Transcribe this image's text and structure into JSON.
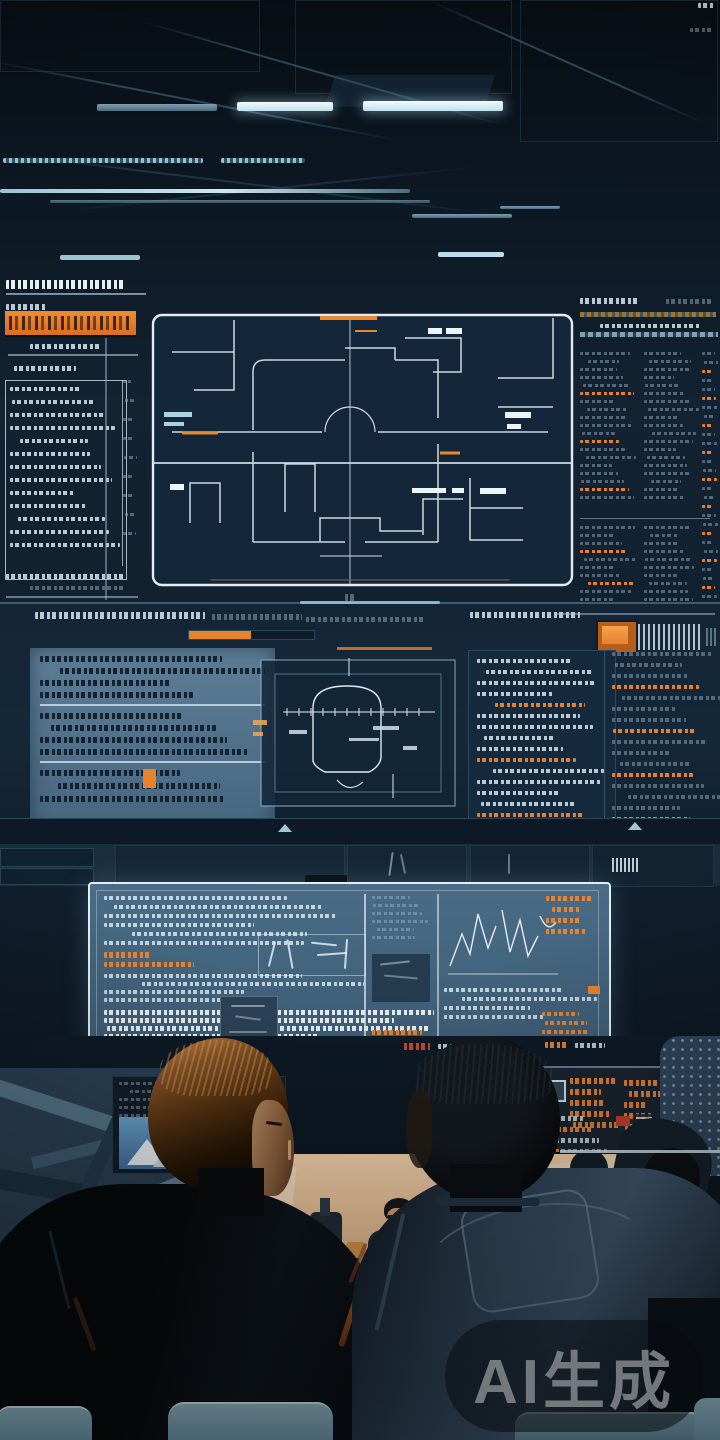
{
  "watermark": {
    "text": "AI生成"
  },
  "palette": {
    "accent_orange": "#e8822f",
    "screen_navy": "#16293c",
    "panel_steel_blue": "#4a6a84",
    "light_cyan": "#cfe7f0",
    "warm_peach": "#f0c89e",
    "chair_teal": "#8fb9c8"
  }
}
